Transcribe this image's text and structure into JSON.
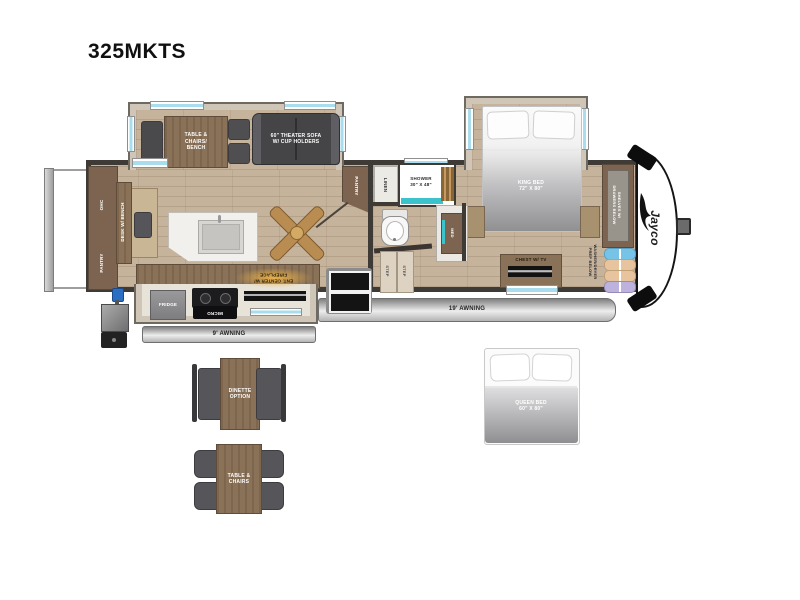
{
  "title": "325MKTS",
  "brand": "Jayco",
  "labels": {
    "tableChairsBench": "TABLE &\nCHAIRS/\nBENCH",
    "theaterSofa": "60\" THEATER SOFA\nW/ CUP HOLDERS",
    "kingBed": "KING BED\n72\" X 80\"",
    "ohc": "OHC",
    "deskBench": "DESK W/ BENCH",
    "pantry": "PANTRY",
    "linen": "LINEN",
    "shower": "SHOWER\n30\" X 48\"",
    "med": "MED",
    "step": "STEP",
    "fridge": "FRIDGE",
    "micro": "MICRO",
    "entCenter": "ENT. CENTER W/\nFIREPLACE",
    "awning9": "9' AWNING",
    "awning19": "19' AWNING",
    "chestTv": "CHEST W/ TV",
    "shelves": "SHELVES W/\nDRAWERS BELOW",
    "washerDryer": "WASHER/DRYER\nPREP BELOW"
  },
  "options": {
    "dinette": "DINETTE\nOPTION",
    "tableChairs": "TABLE &\nCHAIRS",
    "queenBed": "QUEEN BED\n60\" X 80\""
  },
  "colors": {
    "floorWood": "#c6b39c",
    "cabinetBrown": "#7d6450",
    "slideTrim": "#cfc6b8",
    "wallDark": "#3e3a36",
    "furnitureGray": "#55555a",
    "windowBlue": "#a9dcec",
    "showerTeal": "#3cc2ca",
    "fireplaceAmber": "#eeb446",
    "awningGray": "#9f9f9f"
  }
}
